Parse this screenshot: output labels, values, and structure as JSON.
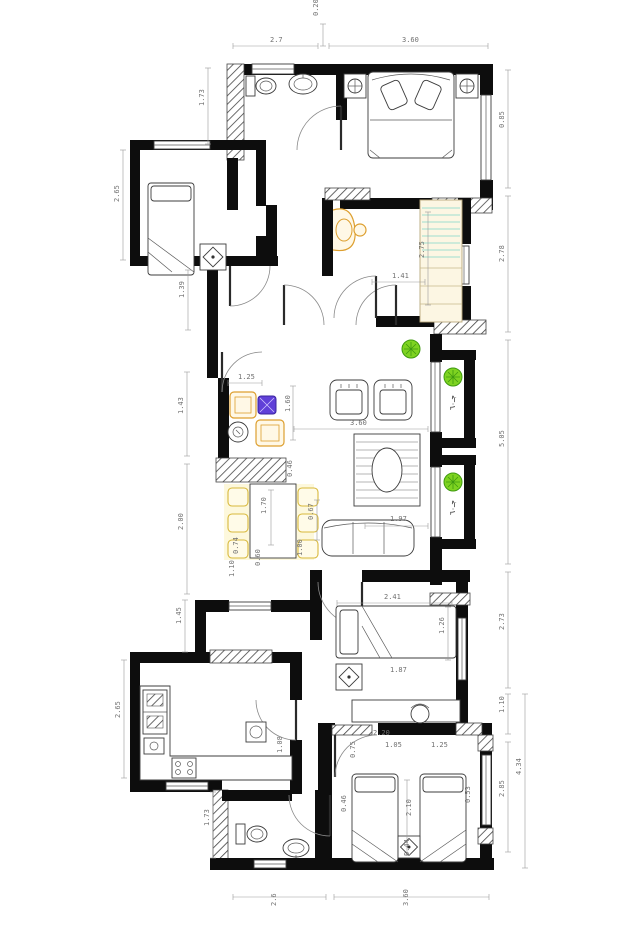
{
  "meta": {
    "type": "architectural floor plan",
    "units": "m"
  },
  "colors": {
    "wall": "#0d0d0d",
    "furniture_line": "#3c3c3c",
    "dimension_text": "#707070",
    "accent_orange": "#dd9f2f",
    "accent_yellow": "#d8b93c",
    "accent_purple": "#6040d8",
    "plant_green": "#6ec72e",
    "wardrobe_teal": "#7fd4c8",
    "wardrobe_cream": "#fcf6e3"
  },
  "window_tags": [
    {
      "t": "جـ٦٠",
      "x": 455,
      "y": 410,
      "r": -90
    },
    {
      "t": "جـ٦٠",
      "x": 455,
      "y": 515,
      "r": -90
    }
  ],
  "dimensions": [
    {
      "t": "2.7",
      "x": 270,
      "y": 42,
      "r": 0,
      "line": [
        233,
        46,
        318,
        46
      ]
    },
    {
      "t": "0.20",
      "x": 318,
      "y": 16,
      "r": -90,
      "line": [
        323,
        24,
        323,
        46
      ]
    },
    {
      "t": "3.60",
      "x": 402,
      "y": 42,
      "r": 0,
      "line": [
        329,
        46,
        488,
        46
      ]
    },
    {
      "t": "0.85",
      "x": 504,
      "y": 128,
      "r": -90,
      "line": [
        508,
        70,
        508,
        188
      ]
    },
    {
      "t": "2.78",
      "x": 504,
      "y": 262,
      "r": -90,
      "line": [
        508,
        196,
        508,
        332
      ]
    },
    {
      "t": "5.05",
      "x": 504,
      "y": 447,
      "r": -90,
      "line": [
        508,
        340,
        508,
        564
      ]
    },
    {
      "t": "2.73",
      "x": 504,
      "y": 630,
      "r": -90,
      "line": [
        508,
        572,
        508,
        688
      ]
    },
    {
      "t": "1.10",
      "x": 504,
      "y": 713,
      "r": -90,
      "line": [
        508,
        694,
        508,
        734
      ]
    },
    {
      "t": "2.85",
      "x": 504,
      "y": 797,
      "r": -90,
      "line": [
        508,
        742,
        508,
        852
      ]
    },
    {
      "t": "4.34",
      "x": 521,
      "y": 775,
      "r": -90,
      "line": [
        525,
        694,
        525,
        868
      ]
    },
    {
      "t": "2.6",
      "x": 276,
      "y": 906,
      "r": -90,
      "line": [
        233,
        897,
        326,
        897
      ]
    },
    {
      "t": "3.60",
      "x": 408,
      "y": 906,
      "r": -90,
      "line": [
        334,
        897,
        489,
        897
      ]
    },
    {
      "t": "1.73",
      "x": 204,
      "y": 106,
      "r": -90,
      "line": [
        208,
        68,
        208,
        144
      ]
    },
    {
      "t": "2.65",
      "x": 119,
      "y": 202,
      "r": -90,
      "line": [
        123,
        150,
        123,
        260
      ]
    },
    {
      "t": "1.39",
      "x": 184,
      "y": 298,
      "r": -90,
      "line": [
        188,
        270,
        188,
        330
      ]
    },
    {
      "t": "1.43",
      "x": 183,
      "y": 414,
      "r": -90,
      "line": [
        187,
        372,
        187,
        456
      ]
    },
    {
      "t": "2.00",
      "x": 183,
      "y": 530,
      "r": -90,
      "line": [
        187,
        464,
        187,
        594
      ]
    },
    {
      "t": "1.45",
      "x": 181,
      "y": 624,
      "r": -90,
      "line": [
        185,
        600,
        185,
        652
      ]
    },
    {
      "t": "2.65",
      "x": 120,
      "y": 718,
      "r": -90,
      "line": [
        124,
        660,
        124,
        778
      ]
    },
    {
      "t": "1.73",
      "x": 209,
      "y": 826,
      "r": -90,
      "line": [
        213,
        792,
        213,
        858
      ]
    },
    {
      "t": "2.75",
      "x": 424,
      "y": 258,
      "r": -90,
      "line": [
        428,
        212,
        428,
        305
      ]
    },
    {
      "t": "1.41",
      "x": 392,
      "y": 278,
      "r": 0,
      "line": [
        372,
        282,
        425,
        282
      ]
    },
    {
      "t": "1.25",
      "x": 238,
      "y": 379,
      "r": 0,
      "line": [
        228,
        383,
        262,
        383
      ]
    },
    {
      "t": "1.60",
      "x": 290,
      "y": 412,
      "r": -90,
      "line": [
        293,
        386,
        293,
        440
      ]
    },
    {
      "t": "3.60",
      "x": 350,
      "y": 425,
      "r": 0,
      "line": [
        294,
        429,
        428,
        429
      ]
    },
    {
      "t": "0.46",
      "x": 292,
      "y": 477,
      "r": -90
    },
    {
      "t": "1.70",
      "x": 266,
      "y": 514,
      "r": -90,
      "line": [
        271,
        490,
        271,
        545
      ]
    },
    {
      "t": "1.97",
      "x": 390,
      "y": 521,
      "r": 0,
      "line": [
        365,
        526,
        428,
        526
      ]
    },
    {
      "t": "0.67",
      "x": 313,
      "y": 520,
      "r": -90,
      "line": [
        317,
        500,
        317,
        540
      ]
    },
    {
      "t": "1.00",
      "x": 302,
      "y": 556,
      "r": -90
    },
    {
      "t": "0.74",
      "x": 238,
      "y": 554,
      "r": -90
    },
    {
      "t": "0.60",
      "x": 260,
      "y": 566,
      "r": -90
    },
    {
      "t": "1.10",
      "x": 234,
      "y": 577,
      "r": -90
    },
    {
      "t": "2.41",
      "x": 384,
      "y": 599,
      "r": 0,
      "line": [
        337,
        603,
        452,
        603
      ]
    },
    {
      "t": "1.26",
      "x": 444,
      "y": 634,
      "r": -90,
      "line": [
        448,
        607,
        448,
        660
      ]
    },
    {
      "t": "1.87",
      "x": 390,
      "y": 672,
      "r": 0
    },
    {
      "t": "2.20",
      "x": 373,
      "y": 735,
      "r": 0
    },
    {
      "t": "1.05",
      "x": 385,
      "y": 747,
      "r": 0
    },
    {
      "t": "1.25",
      "x": 431,
      "y": 747,
      "r": 0
    },
    {
      "t": "0.75",
      "x": 355,
      "y": 758,
      "r": -90
    },
    {
      "t": "1.08",
      "x": 282,
      "y": 753,
      "r": -90
    },
    {
      "t": "2.10",
      "x": 411,
      "y": 816,
      "r": -90,
      "line": [
        407,
        780,
        407,
        855
      ]
    },
    {
      "t": "0.46",
      "x": 346,
      "y": 812,
      "r": -90
    },
    {
      "t": "0.44",
      "x": 409,
      "y": 856,
      "r": -90
    },
    {
      "t": "0.53",
      "x": 470,
      "y": 803,
      "r": -90
    }
  ]
}
